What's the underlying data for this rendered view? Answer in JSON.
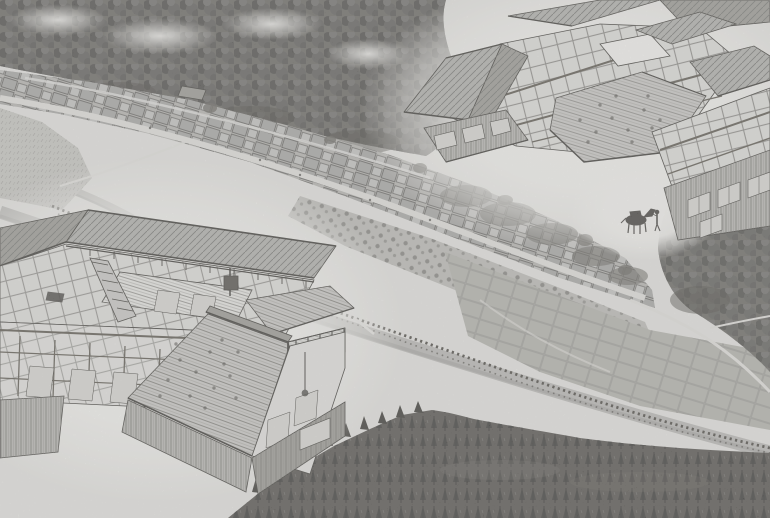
{
  "canvas": {
    "viewbox": "0 0 770 518"
  },
  "palette": {
    "paper": "#e6e5e2",
    "halo": "#f6f5f2",
    "mist": "#efeeeb",
    "road": "#e2e1de",
    "water": "#b7b6b3",
    "water_dark": "#a3a29f",
    "grass": "#c6c5c1",
    "village_base": "#b3b2ae",
    "orchard": "#bab9b5",
    "roof_light": "#c9c8c5",
    "roof_mid": "#aeada9",
    "roof_dark": "#96958f",
    "wall_plank": "#b5b4b0",
    "frame_bg": "#e0dfdc",
    "interior": "#e4e3e0",
    "floor_boards": "#e8e7e4",
    "field": "#b1b0aa",
    "forest_top": "#615f5a",
    "forest_dark": "#423f3a",
    "forest_bottom": "#4a4743",
    "conifer_dark": "#2e2c28",
    "forest_light": "#6e6b66",
    "ink": "#312f2b",
    "beam": "#545047",
    "horse": "#393633",
    "window_light": "#d9d8d4",
    "dark_fixture": "#4a4742"
  }
}
